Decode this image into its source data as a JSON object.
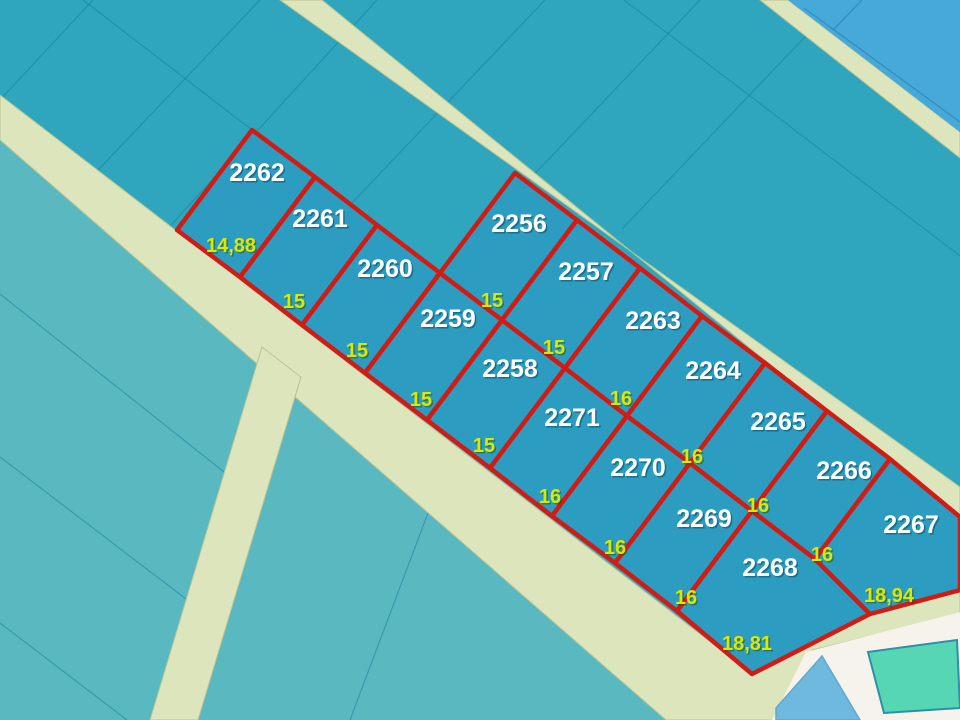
{
  "map": {
    "colors": {
      "background": "#2FA6BE",
      "light_region": "#5AB8C0",
      "road_fill": "#DCE5BC",
      "road_edge": "#B6C493",
      "gridline": "#17859E",
      "blue_zone": "#46A9D8",
      "blue_zone_line": "#2E8CBE",
      "white_area": "#F6F3EC",
      "blue_plot": "#6FB9DE",
      "blue_plot_edge": "#5FA8D0",
      "green_plot": "#57D6B4",
      "green_plot_edge": "#2E8FA8",
      "parcel_fill": "#2C9DC0",
      "parcel_boundary": "#D11B15",
      "parcel_number_color": "#FFFFFF",
      "dimension_color": "#DCE800",
      "number_shadow": "rgba(0,55,75,0.45)",
      "dimension_shadow": "rgba(30,70,0,0.45)"
    },
    "boundary_width": 4.5,
    "number_font_size": 25,
    "dimension_font_size": 20,
    "shapes": [
      {
        "name": "map-background",
        "type": "rect",
        "x": 0,
        "y": 0,
        "w": 960,
        "h": 720,
        "fill": "background"
      },
      {
        "name": "region-light-teal",
        "type": "polygon",
        "points": "0,140 700,690 700,720 0,720",
        "fill": "light_region"
      },
      {
        "name": "cadastral-gridline",
        "type": "line",
        "x1": 0,
        "y1": 294,
        "x2": 224,
        "y2": 472,
        "stroke": "gridline",
        "sw": 1.2,
        "opacity": 0.55
      },
      {
        "name": "cadastral-gridline",
        "type": "line",
        "x1": 0,
        "y1": 457,
        "x2": 186,
        "y2": 599,
        "stroke": "gridline",
        "sw": 1.2,
        "opacity": 0.55
      },
      {
        "name": "cadastral-gridline",
        "type": "line",
        "x1": 0,
        "y1": 623,
        "x2": 127,
        "y2": 720,
        "stroke": "gridline",
        "sw": 1.2,
        "opacity": 0.55
      },
      {
        "name": "cadastral-gridline",
        "type": "line",
        "x1": 437,
        "y1": 489,
        "x2": 350,
        "y2": 720,
        "stroke": "gridline",
        "sw": 1.2,
        "opacity": 0.55
      },
      {
        "name": "cadastral-gridline",
        "type": "line",
        "x1": 93,
        "y1": 0,
        "x2": 0,
        "y2": 100,
        "stroke": "gridline",
        "sw": 1.2,
        "opacity": 0.6
      },
      {
        "name": "cadastral-gridline",
        "type": "line",
        "x1": 260,
        "y1": 0,
        "x2": 98,
        "y2": 170,
        "stroke": "gridline",
        "sw": 1.2,
        "opacity": 0.6
      },
      {
        "name": "cadastral-gridline",
        "type": "line",
        "x1": 377,
        "y1": 0,
        "x2": 170,
        "y2": 226,
        "stroke": "gridline",
        "sw": 1.2,
        "opacity": 0.6
      },
      {
        "name": "cadastral-gridline",
        "type": "line",
        "x1": 545,
        "y1": 0,
        "x2": 350,
        "y2": 205,
        "stroke": "gridline",
        "sw": 1.2,
        "opacity": 0.6
      },
      {
        "name": "cadastral-gridline",
        "type": "line",
        "x1": 700,
        "y1": 0,
        "x2": 527,
        "y2": 182,
        "stroke": "gridline",
        "sw": 1.2,
        "opacity": 0.6
      },
      {
        "name": "cadastral-gridline",
        "type": "line",
        "x1": 840,
        "y1": 0,
        "x2": 622,
        "y2": 229,
        "stroke": "gridline",
        "sw": 1.2,
        "opacity": 0.6
      },
      {
        "name": "cadastral-gridline",
        "type": "line",
        "x1": 83,
        "y1": 0,
        "x2": 252,
        "y2": 130,
        "stroke": "gridline",
        "sw": 1.2,
        "opacity": 0.6
      },
      {
        "name": "cadastral-gridline",
        "type": "line",
        "x1": 624,
        "y1": 0,
        "x2": 960,
        "y2": 256,
        "stroke": "gridline",
        "sw": 1.2,
        "opacity": 0.6
      },
      {
        "name": "road-frontage",
        "type": "polygon",
        "points": "0,95 752,674 870,614 960,592 960,614 812,650 778,720 666,720 0,140",
        "fill": "road_fill",
        "stroke": "road_edge",
        "sw": 1
      },
      {
        "name": "road-branch-south",
        "type": "polygon",
        "points": "262,347 301,377 198,720 150,720",
        "fill": "road_fill",
        "stroke": "road_edge",
        "sw": 1
      },
      {
        "name": "road-upper-right",
        "type": "polygon",
        "points": "760,0 788,0 960,132 960,158",
        "fill": "road_fill",
        "stroke": "road_edge",
        "sw": 1
      },
      {
        "name": "road-back",
        "type": "polygon",
        "points": "280,0 322,0 960,519 960,487",
        "fill": "road_fill",
        "stroke": "road_edge",
        "sw": 1
      },
      {
        "name": "blue-zone",
        "type": "polygon",
        "points": "788,0 960,0 960,132",
        "fill": "blue_zone"
      },
      {
        "name": "blue-zone-line",
        "type": "line",
        "x1": 804,
        "y1": 8,
        "x2": 960,
        "y2": 122,
        "stroke": "blue_zone_line",
        "sw": 1.3,
        "opacity": 0.9
      },
      {
        "name": "blue-zone-line",
        "type": "line",
        "x1": 862,
        "y1": 0,
        "x2": 833,
        "y2": 30,
        "stroke": "blue_zone_line",
        "sw": 1.3,
        "opacity": 0.9
      },
      {
        "name": "white-open-area",
        "type": "polygon",
        "points": "806,652 960,612 960,720 772,720",
        "fill": "white_area"
      },
      {
        "name": "blue-plot",
        "type": "polygon",
        "points": "776,708 822,656 860,720 776,720",
        "fill": "blue_plot",
        "stroke": "blue_plot_edge",
        "sw": 1.5
      },
      {
        "name": "green-plot",
        "type": "polygon",
        "points": "868,652 957,640 960,708 884,713",
        "fill": "green_plot",
        "stroke": "green_plot_edge",
        "sw": 2
      }
    ],
    "parcels": [
      {
        "number": "2262",
        "dimension": "14,88",
        "points": "177,230 240,277 315,177 252,130",
        "num_pos": [
          257,
          172
        ],
        "dim_pos": [
          231,
          245
        ]
      },
      {
        "number": "2261",
        "dimension": "15",
        "points": "240,277 302,325 377,225 315,177",
        "num_pos": [
          320,
          218
        ],
        "dim_pos": [
          294,
          301
        ]
      },
      {
        "number": "2260",
        "dimension": "15",
        "points": "302,325 365,373 440,273 377,225",
        "num_pos": [
          385,
          268
        ],
        "dim_pos": [
          357,
          350
        ]
      },
      {
        "number": "2259",
        "dimension": "15",
        "points": "365,373 427,420 502,320 440,273",
        "num_pos": [
          448,
          318
        ],
        "dim_pos": [
          421,
          399
        ]
      },
      {
        "number": "2258",
        "dimension": "15",
        "points": "427,420 490,468 565,368 502,320",
        "num_pos": [
          510,
          368
        ],
        "dim_pos": [
          484,
          445
        ]
      },
      {
        "number": "2271",
        "dimension": "16",
        "points": "490,468 552,516 627,416 565,368",
        "num_pos": [
          572,
          417
        ],
        "dim_pos": [
          550,
          496
        ]
      },
      {
        "number": "2270",
        "dimension": "16",
        "points": "552,516 615,563 690,463 627,416",
        "num_pos": [
          638,
          467
        ],
        "dim_pos": [
          615,
          547
        ]
      },
      {
        "number": "2269",
        "dimension": "16",
        "points": "615,563 677,611 752,511 690,463",
        "num_pos": [
          704,
          518
        ],
        "dim_pos": [
          686,
          597
        ]
      },
      {
        "number": "2268",
        "dimension": "18,81",
        "points": "677,611 752,674 870,614 815,559 752,511",
        "num_pos": [
          770,
          567
        ],
        "dim_pos": [
          747,
          643
        ]
      },
      {
        "number": "2256",
        "dimension": "15",
        "points": "440,273 502,320 577,220 515,173",
        "num_pos": [
          519,
          223
        ],
        "dim_pos": [
          492,
          300
        ]
      },
      {
        "number": "2257",
        "dimension": "15",
        "points": "502,320 565,368 640,268 577,220",
        "num_pos": [
          586,
          271
        ],
        "dim_pos": [
          554,
          347
        ]
      },
      {
        "number": "2263",
        "dimension": "16",
        "points": "565,368 627,416 702,316 640,268",
        "num_pos": [
          653,
          320
        ],
        "dim_pos": [
          621,
          398
        ]
      },
      {
        "number": "2264",
        "dimension": "16",
        "points": "627,416 690,463 765,363 702,316",
        "num_pos": [
          713,
          370
        ],
        "dim_pos": [
          692,
          456
        ]
      },
      {
        "number": "2265",
        "dimension": "16",
        "points": "690,463 752,511 827,411 765,363",
        "num_pos": [
          778,
          421
        ],
        "dim_pos": [
          758,
          505
        ]
      },
      {
        "number": "2266",
        "dimension": "16",
        "points": "752,511 815,559 890,459 827,411",
        "num_pos": [
          844,
          470
        ],
        "dim_pos": [
          822,
          554
        ]
      },
      {
        "number": "2267",
        "dimension": "18,94",
        "points": "815,559 870,614 960,590 960,517 890,459",
        "num_pos": [
          911,
          524
        ],
        "dim_pos": [
          889,
          595
        ]
      }
    ]
  }
}
